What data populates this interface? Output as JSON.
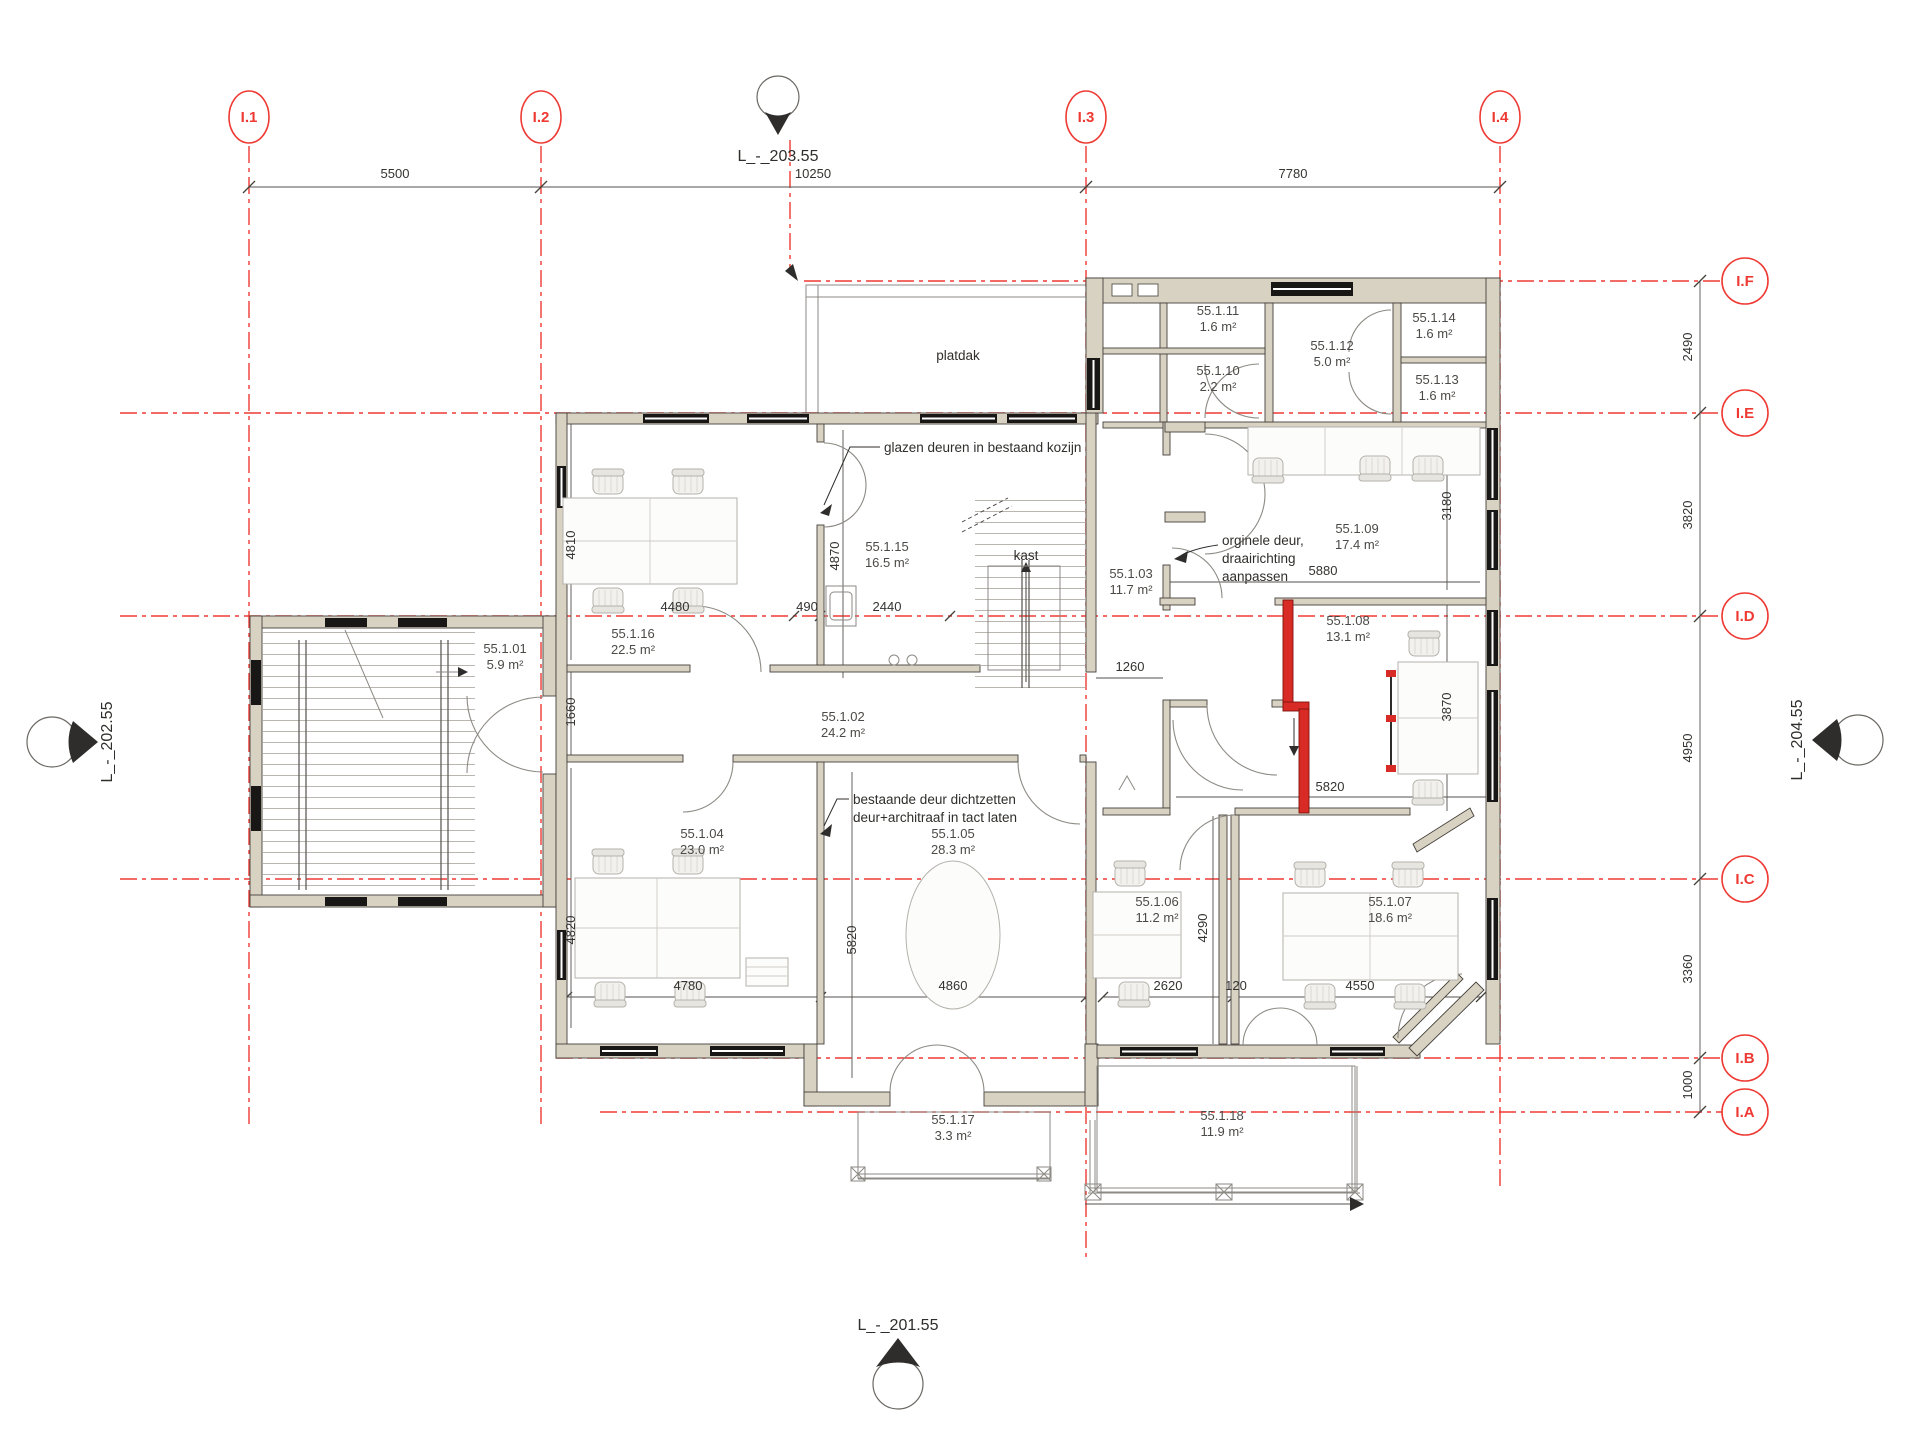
{
  "drawing": {
    "levels": {
      "top": "L_-_203.55",
      "bottom": "L_-_201.55",
      "left": "L_-_202.55",
      "right": "L_-_204.55"
    },
    "grid": {
      "cols": [
        "I.1",
        "I.2",
        "I.3",
        "I.4"
      ],
      "rows": [
        "I.F",
        "I.E",
        "I.D",
        "I.C",
        "I.B",
        "I.A"
      ]
    },
    "dims": {
      "top": [
        "5500",
        "10250",
        "7780"
      ],
      "right": [
        "2490",
        "3820",
        "4950",
        "3360",
        "1000"
      ],
      "interior": {
        "d4810": "4810",
        "d4480": "4480",
        "d490": "490",
        "d2440": "2440",
        "d4870": "4870",
        "d1660": "1660",
        "d4820": "4820",
        "d4780": "4780",
        "d5820a": "5820",
        "d4860": "4860",
        "d1260": "1260",
        "d5880": "5880",
        "d3180": "3180",
        "d3870": "3870",
        "d5820b": "5820",
        "d4290": "4290",
        "d2620": "2620",
        "d120": "120",
        "d4550": "4550"
      }
    },
    "rooms": [
      {
        "id": "55.1.01",
        "area": "5.9 m²"
      },
      {
        "id": "55.1.02",
        "area": "24.2 m²"
      },
      {
        "id": "55.1.03",
        "area": "11.7 m²"
      },
      {
        "id": "55.1.04",
        "area": "23.0 m²"
      },
      {
        "id": "55.1.05",
        "area": "28.3 m²"
      },
      {
        "id": "55.1.06",
        "area": "11.2 m²"
      },
      {
        "id": "55.1.07",
        "area": "18.6 m²"
      },
      {
        "id": "55.1.08",
        "area": "13.1 m²"
      },
      {
        "id": "55.1.09",
        "area": "17.4 m²"
      },
      {
        "id": "55.1.10",
        "area": "2.2 m²"
      },
      {
        "id": "55.1.11",
        "area": "1.6 m²"
      },
      {
        "id": "55.1.12",
        "area": "5.0 m²"
      },
      {
        "id": "55.1.13",
        "area": "1.6 m²"
      },
      {
        "id": "55.1.14",
        "area": "1.6 m²"
      },
      {
        "id": "55.1.15",
        "area": "16.5 m²"
      },
      {
        "id": "55.1.16",
        "area": "22.5 m²"
      },
      {
        "id": "55.1.17",
        "area": "3.3 m²"
      },
      {
        "id": "55.1.18",
        "area": "11.9 m²"
      }
    ],
    "annotations": {
      "platdak": "platdak",
      "kast": "kast",
      "glazen": "glazen deuren in bestaand kozijn",
      "orginele": [
        "orginele deur,",
        "draairichting",
        "aanpassen"
      ],
      "bestaande": [
        "bestaande deur dichtzetten",
        "deur+architraaf in tact laten"
      ]
    },
    "colors": {
      "grid_red": "#ee3a33",
      "wall_fill": "#d8d2c3",
      "wall_stroke": "#45413b",
      "highlight_red": "#d92b26",
      "dim_gray": "#55524e"
    }
  }
}
